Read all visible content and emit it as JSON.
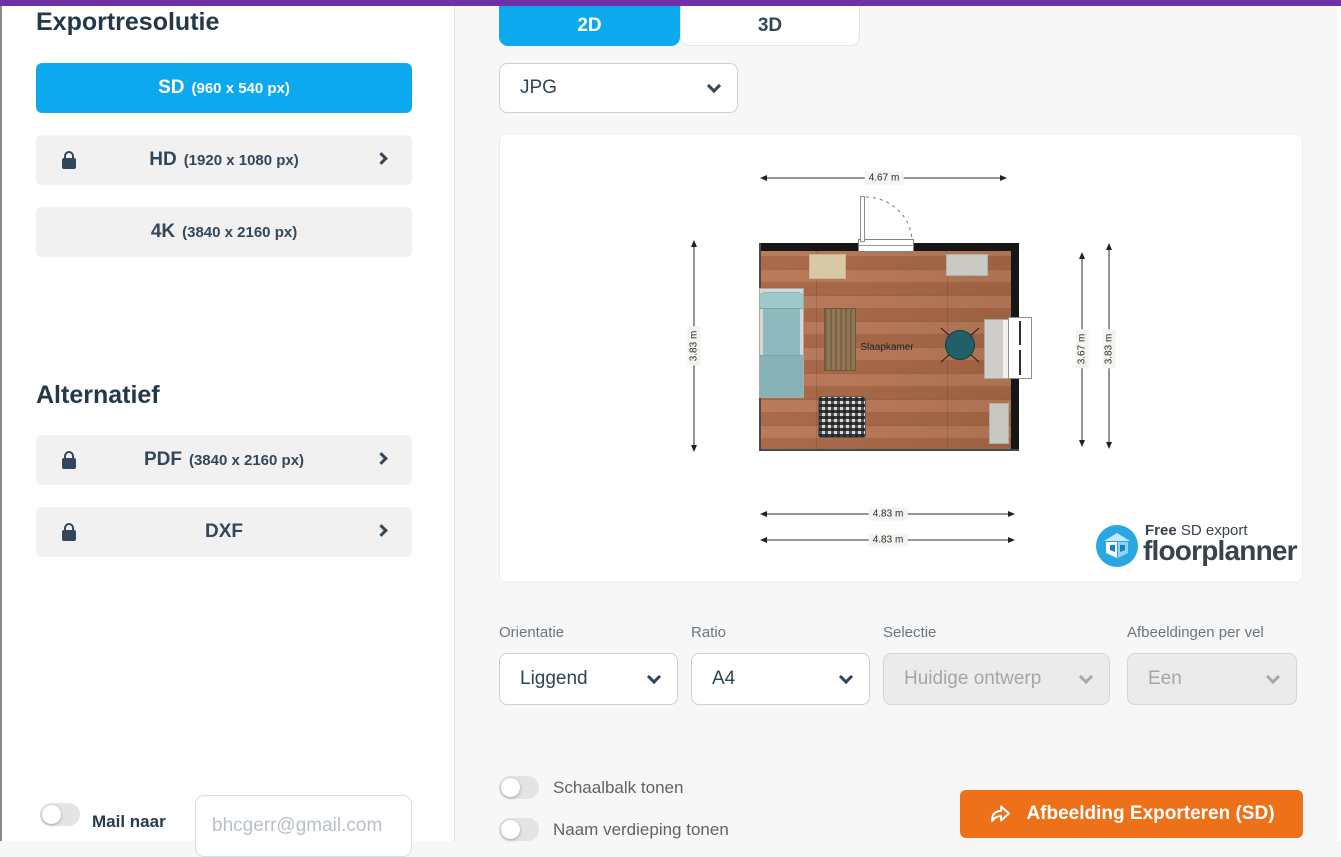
{
  "colors": {
    "accent_purple": "#7030A8",
    "accent_blue": "#0DA9EF",
    "accent_orange": "#EC7118",
    "text_dark": "#2E4356"
  },
  "sidebar": {
    "title": "Exportresolutie",
    "resolutions": [
      {
        "main": "SD",
        "detail": "(960 x 540 px)"
      },
      {
        "main": "HD",
        "detail": "(1920 x 1080 px)"
      },
      {
        "main": "4K",
        "detail": "(3840 x 2160 px)"
      }
    ],
    "alt_title": "Alternatief",
    "alternatives": [
      {
        "main": "PDF",
        "detail": "(3840 x 2160 px)"
      },
      {
        "main": "DXF",
        "detail": ""
      }
    ],
    "mail": {
      "label": "Mail naar",
      "placeholder": "bhcgerr@gmail.com"
    }
  },
  "tabs": {
    "tab_2d": "2D",
    "tab_3d": "3D"
  },
  "format_select": {
    "value": "JPG"
  },
  "preview": {
    "room_label": "Slaapkamer",
    "dims": {
      "top": "4.67 m",
      "left": "3.83 m",
      "right_inner": "3.67 m",
      "right_outer": "3.83 m",
      "bottom_1": "4.83 m",
      "bottom_2": "4.83 m"
    },
    "watermark": {
      "line1_bold": "Free",
      "line1_rest": " SD export",
      "line2": "floorplanner"
    }
  },
  "options": {
    "orientation": {
      "label": "Orientatie",
      "value": "Liggend"
    },
    "ratio": {
      "label": "Ratio",
      "value": "A4"
    },
    "selection": {
      "label": "Selectie",
      "value": "Huidige ontwerp"
    },
    "images_per_sheet": {
      "label": "Afbeeldingen per vel",
      "value": "Een"
    }
  },
  "toggles": [
    {
      "label": "Schaalbalk tonen"
    },
    {
      "label": "Naam verdieping tonen"
    }
  ],
  "export_button": {
    "label": "Afbeelding Exporteren (SD)"
  }
}
